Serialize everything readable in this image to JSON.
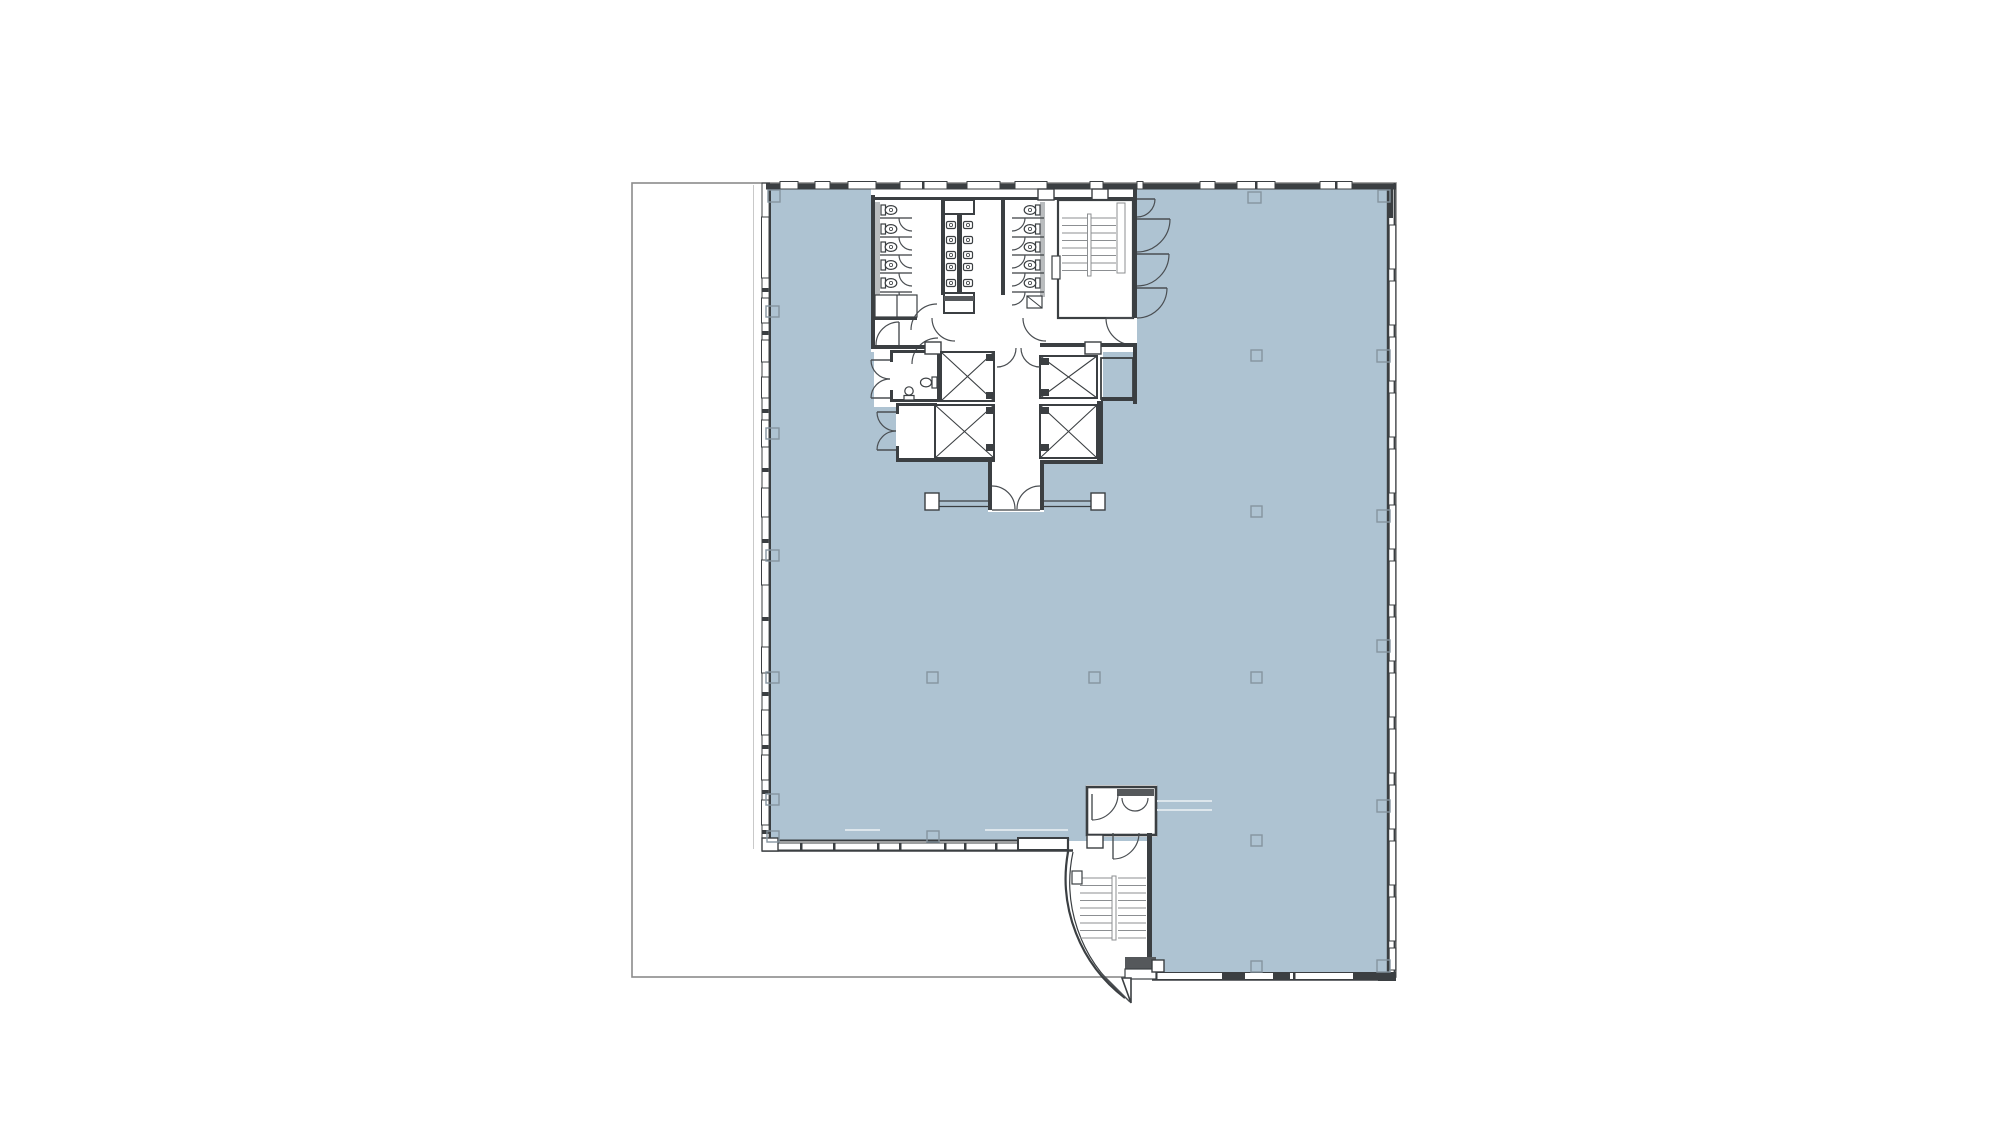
{
  "document": {
    "kind": "architectural-floor-plan",
    "visible_text": [],
    "description_names": [
      "lease-boundary",
      "tenant-open-floor-area",
      "building-core",
      "restroom-left",
      "restroom-right",
      "lavatory-bank",
      "unisex-wc",
      "elevator-lobby",
      "north-stair",
      "south-stair",
      "south-vestibule",
      "window-wall",
      "column-grid"
    ]
  },
  "colors": {
    "bg": "#ffffff",
    "floor": "#aec3d2",
    "wall": "#3b3f42",
    "boundary": "#8b8b8b",
    "column": "#85949f",
    "door": "#4a4e52",
    "tread": "#8c8f92",
    "gray": "#b9bcbe",
    "dark": "#55585b",
    "fixture": "#3b3f42",
    "faint": "#dde6ec",
    "thin": "#c9c9c9"
  },
  "plan": {
    "boundary": {
      "x": 632,
      "y": 183,
      "width": 764,
      "height": 794
    },
    "counts": {
      "toilet_stalls_left": 5,
      "toilet_stalls_right": 5,
      "sinks": 10,
      "elevators": 4,
      "stairs": 2,
      "east_core_door_swings": 4
    }
  }
}
